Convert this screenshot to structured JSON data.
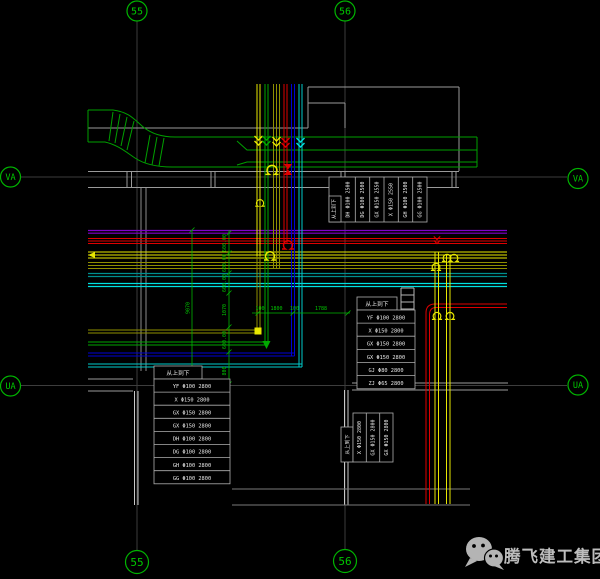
{
  "drawing_type": "CAD pipe and duct layout plan",
  "grid_markers": {
    "top": [
      "55",
      "56"
    ],
    "bottom": [
      "55",
      "56"
    ],
    "left": [
      "VA",
      "UA"
    ],
    "right": [
      "VA",
      "UA"
    ]
  },
  "tables": {
    "top_right": {
      "header": "从上到下",
      "columns": [
        "DH Φ100 2500",
        "DG Φ100 2500",
        "GX Φ150 2550",
        "X Φ150 2550",
        "GH Φ100 2500",
        "GG Φ100 2500"
      ]
    },
    "right": {
      "header": "从上到下",
      "rows": [
        "YF Φ100 2800",
        "X Φ150 2800",
        "GX Φ150 2800",
        "GX Φ150 2800",
        "GJ Φ80 2800",
        "ZJ Φ65 2800"
      ]
    },
    "bottom_left": {
      "header": "从上到下",
      "rows": [
        "YF Φ100 2800",
        "X Φ150 2800",
        "GX Φ150 2800",
        "GX Φ150 2800",
        "DH Φ100 2800",
        "DG Φ100 2800",
        "GH Φ100 2800",
        "GG Φ100 2800"
      ]
    },
    "bottom_center": {
      "header": "从上到下",
      "columns": [
        "X Φ150 2800",
        "GX Φ150 2800",
        "GX Φ150 2800"
      ]
    }
  },
  "dimensions": {
    "horizontal": [
      "100",
      "1800",
      "100",
      "1788"
    ],
    "vertical_chain": [
      "600.00",
      "600.00",
      "600.00",
      "1070",
      "600.00",
      "800"
    ],
    "vertical_total": "9070"
  },
  "watermark": {
    "company": "腾飞建工集团"
  },
  "colors": {
    "background": "#000000",
    "grid_green": "#00b400",
    "wall_gray": "#9a9a9a",
    "pipe_purple": "#8000cc",
    "pipe_red": "#e00000",
    "pipe_yellow": "#e8e800",
    "pipe_olive": "#8f8f00",
    "pipe_teal": "#008f8f",
    "pipe_cyan": "#00e0e0",
    "pipe_blue": "#0000d8",
    "pipe_green": "#00a800",
    "table_border": "#b0b0b0",
    "watermark_gray": "#bdbdbd"
  }
}
